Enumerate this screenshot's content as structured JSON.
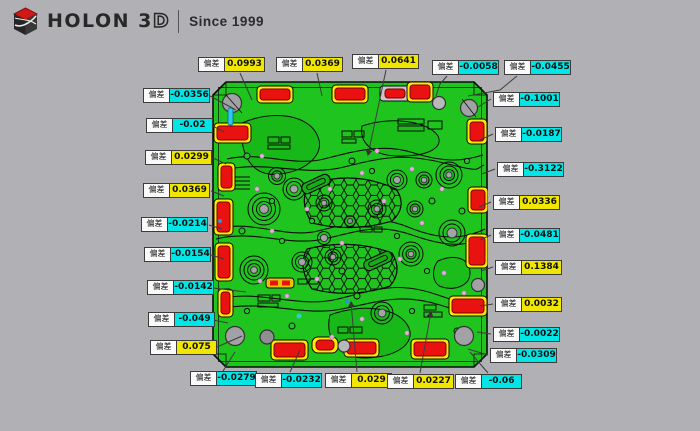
{
  "brand": {
    "name_main": "HOLON 3",
    "name_outline": "D",
    "tagline": "Since 1999"
  },
  "annotation_label": "偏差",
  "annotations": {
    "top": [
      {
        "value": "0.0993",
        "sign": "pos"
      },
      {
        "value": "0.0369",
        "sign": "pos"
      },
      {
        "value": "0.0641",
        "sign": "pos"
      },
      {
        "value": "-0.0058",
        "sign": "neg"
      },
      {
        "value": "-0.0455",
        "sign": "neg"
      }
    ],
    "left": [
      {
        "value": "-0.0356",
        "sign": "neg"
      },
      {
        "value": "-0.02",
        "sign": "neg"
      },
      {
        "value": "0.0299",
        "sign": "pos"
      },
      {
        "value": "0.0369",
        "sign": "pos"
      },
      {
        "value": "-0.0214",
        "sign": "neg"
      },
      {
        "value": "-0.0154",
        "sign": "neg"
      },
      {
        "value": "-0.0142",
        "sign": "neg"
      },
      {
        "value": "-0.049",
        "sign": "neg"
      },
      {
        "value": "0.075",
        "sign": "pos"
      }
    ],
    "right": [
      {
        "value": "-0.1001",
        "sign": "neg"
      },
      {
        "value": "-0.0187",
        "sign": "neg"
      },
      {
        "value": "-0.3122",
        "sign": "neg"
      },
      {
        "value": "0.0336",
        "sign": "pos"
      },
      {
        "value": "-0.0481",
        "sign": "neg"
      },
      {
        "value": "0.1384",
        "sign": "pos"
      },
      {
        "value": "0.0032",
        "sign": "pos"
      },
      {
        "value": "-0.0022",
        "sign": "neg"
      },
      {
        "value": "-0.0309",
        "sign": "neg"
      }
    ],
    "bottom": [
      {
        "value": "-0.0279",
        "sign": "neg"
      },
      {
        "value": "-0.0232",
        "sign": "neg"
      },
      {
        "value": "0.029",
        "sign": "pos"
      },
      {
        "value": "0.0227",
        "sign": "pos"
      },
      {
        "value": "-0.06",
        "sign": "neg"
      }
    ]
  },
  "colors": {
    "background": "#b1b1b5",
    "positive_badge": "#f0e600",
    "negative_badge": "#00e6e6",
    "part_nominal_green": "#1fc41f",
    "deviation_red": "#ea1111",
    "halo_yellow": "#ffe900",
    "logo_red": "#d01818"
  }
}
